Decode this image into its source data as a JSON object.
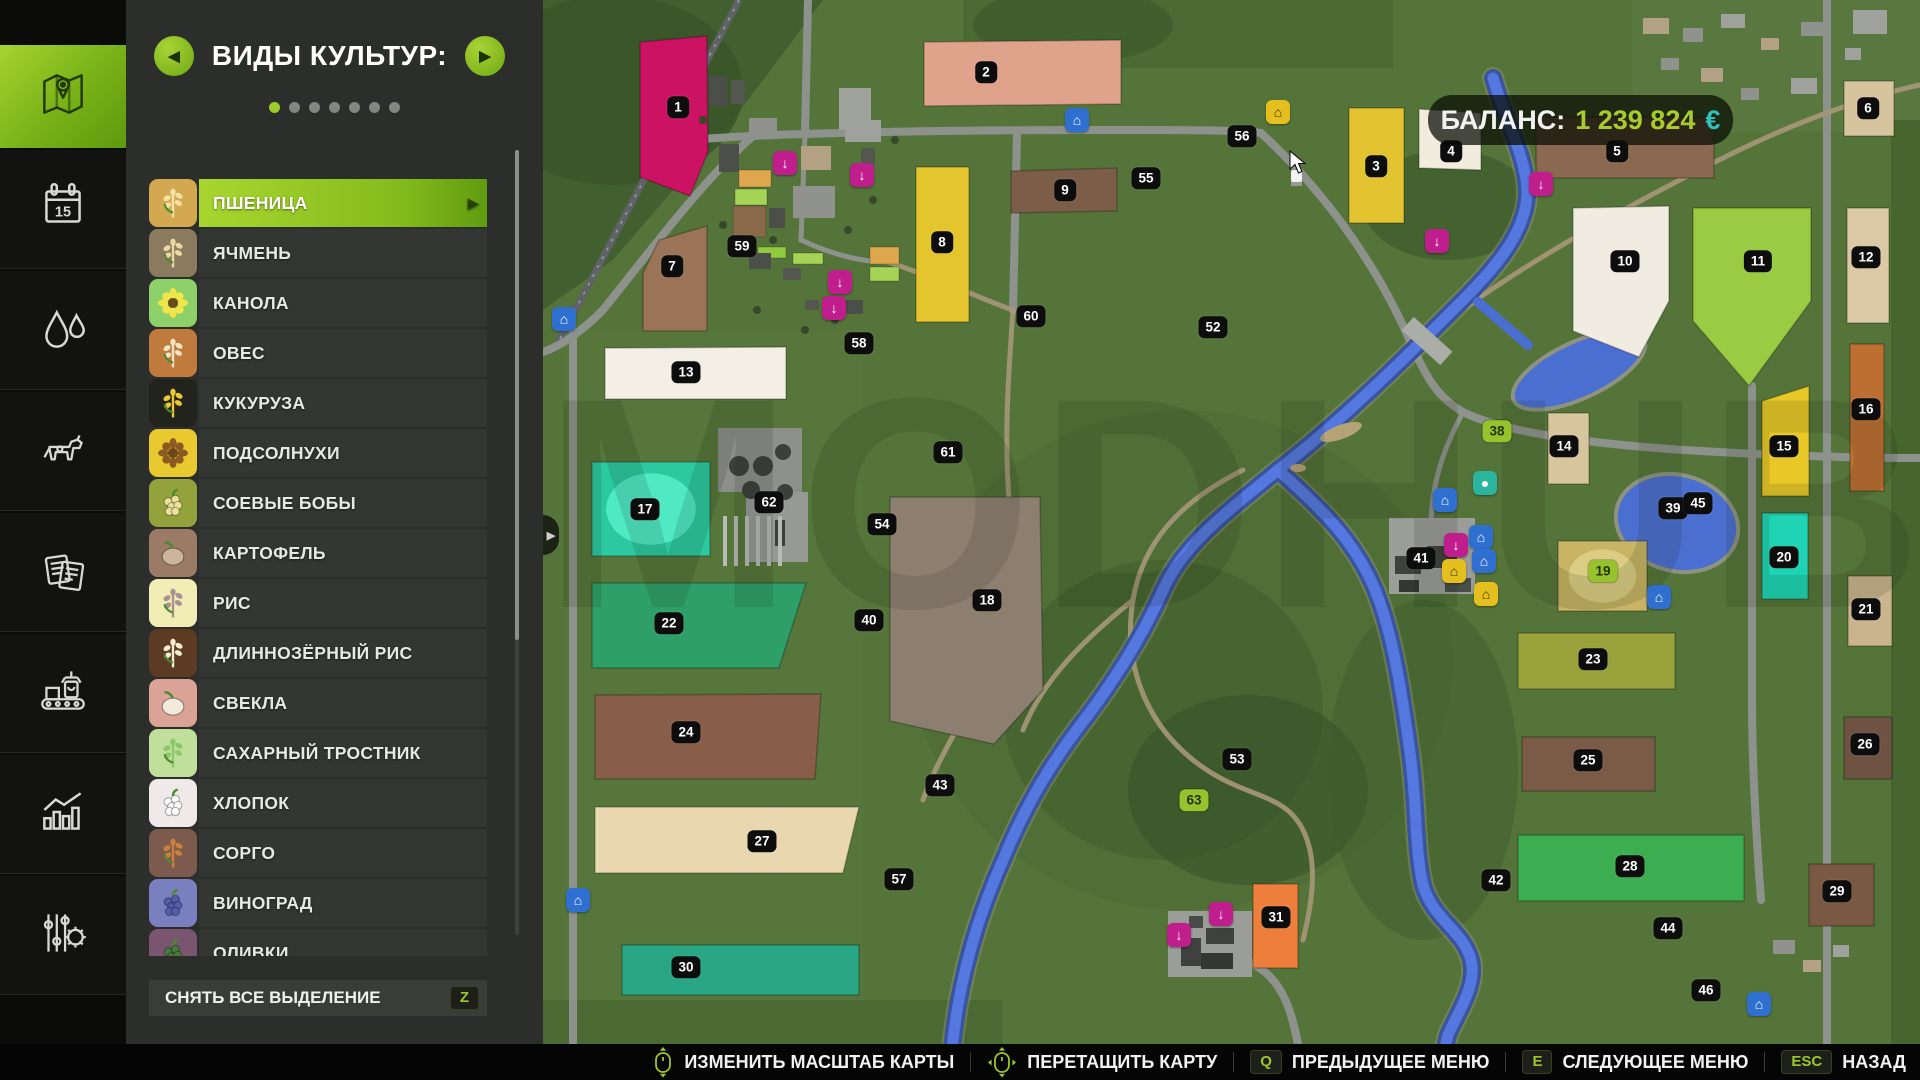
{
  "sidebar": {
    "items": [
      {
        "name": "map-tab",
        "icon": "map-icon",
        "active": true
      },
      {
        "name": "calendar-tab",
        "icon": "calendar-icon",
        "number": "15"
      },
      {
        "name": "weather-tab",
        "icon": "water-drops-icon"
      },
      {
        "name": "animals-tab",
        "icon": "cow-icon"
      },
      {
        "name": "contracts-tab",
        "icon": "documents-icon"
      },
      {
        "name": "production-tab",
        "icon": "conveyor-icon"
      },
      {
        "name": "statistics-tab",
        "icon": "bar-chart-icon"
      },
      {
        "name": "settings-tab",
        "icon": "sliders-gear-icon"
      }
    ]
  },
  "panel": {
    "title": "ВИДЫ КУЛЬТУР:",
    "dots_total": 7,
    "dots_active": 0,
    "crops": [
      {
        "label": "ПШЕНИЦА",
        "selected": true,
        "bg": "#d3a850",
        "fg": "#f5e2a8",
        "shape": "grain"
      },
      {
        "label": "ЯЧМЕНЬ",
        "selected": false,
        "bg": "#8a7a5e",
        "fg": "#ead9a0",
        "shape": "grain"
      },
      {
        "label": "КАНОЛА",
        "selected": false,
        "bg": "#8ed06a",
        "fg": "#f2e549",
        "shape": "flower"
      },
      {
        "label": "ОВЕС",
        "selected": false,
        "bg": "#c07a3e",
        "fg": "#f2e3c2",
        "shape": "grain"
      },
      {
        "label": "КУКУРУЗА",
        "selected": false,
        "bg": "#23231d",
        "fg": "#ecc832",
        "shape": "grain"
      },
      {
        "label": "ПОДСОЛНУХИ",
        "selected": false,
        "bg": "#e9c930",
        "fg": "#8a5a20",
        "shape": "flower"
      },
      {
        "label": "СОЕВЫЕ БОБЫ",
        "selected": false,
        "bg": "#93a23c",
        "fg": "#ece29b",
        "shape": "cluster"
      },
      {
        "label": "КАРТОФЕЛЬ",
        "selected": false,
        "bg": "#9b7b66",
        "fg": "#cbb69c",
        "shape": "round"
      },
      {
        "label": "РИС",
        "selected": false,
        "bg": "#f2edb5",
        "fg": "#a89292",
        "shape": "grain"
      },
      {
        "label": "ДЛИННОЗЁРНЫЙ РИС",
        "selected": false,
        "bg": "#5c3b22",
        "fg": "#f2ecd2",
        "shape": "grain"
      },
      {
        "label": "СВЕКЛА",
        "selected": false,
        "bg": "#daa396",
        "fg": "#f2eada",
        "shape": "round"
      },
      {
        "label": "САХАРНЫЙ ТРОСТНИК",
        "selected": false,
        "bg": "#bfdf9b",
        "fg": "#8cc86a",
        "shape": "grain"
      },
      {
        "label": "ХЛОПОК",
        "selected": false,
        "bg": "#efe9ea",
        "fg": "#ffffff",
        "shape": "cluster"
      },
      {
        "label": "СОРГО",
        "selected": false,
        "bg": "#7d5a4e",
        "fg": "#ca813a",
        "shape": "grain"
      },
      {
        "label": "ВИНОГРАД",
        "selected": false,
        "bg": "#7a7fc0",
        "fg": "#555cab",
        "shape": "cluster"
      },
      {
        "label": "ОЛИВКИ",
        "selected": false,
        "bg": "#7a5570",
        "fg": "#4a7a3a",
        "shape": "cluster"
      }
    ],
    "clear_button": {
      "label": "СНЯТЬ ВСЕ ВЫДЕЛЕНИЕ",
      "key": "Z"
    }
  },
  "map": {
    "balance": {
      "label": "БАЛАНС:",
      "value": "1 239 824",
      "currency": "€"
    },
    "watermark": "MODHUB",
    "fields": [
      {
        "n": "1",
        "color": "#cb1263",
        "points": "97,42 164,36 165,152 147,196 97,177"
      },
      {
        "n": "2",
        "color": "#dfa28b",
        "points": "381,42 578,40 578,104 381,106"
      },
      {
        "n": "3",
        "color": "#e3c430",
        "points": "806,108 861,108 861,223 806,223"
      },
      {
        "n": "4",
        "color": "#f2ecdf",
        "points": "876,109 938,113 938,170 876,168"
      },
      {
        "n": "5",
        "color": "#8a6950",
        "points": "993,117 1171,117 1171,178 993,178"
      },
      {
        "n": "6",
        "color": "#d5c49e",
        "points": "1301,81 1351,81 1351,136 1301,136"
      },
      {
        "n": "7",
        "color": "#9b7356",
        "points": "116,240 164,226 164,331 100,331 100,273"
      },
      {
        "n": "8",
        "color": "#e5c52e",
        "points": "373,167 426,167 426,322 373,322"
      },
      {
        "n": "9",
        "color": "#7c5e48",
        "points": "468,171 574,168 574,211 468,213"
      },
      {
        "n": "10",
        "color": "#f1ece2",
        "points": "1030,208 1126,206 1126,301 1096,357 1030,331"
      },
      {
        "n": "11",
        "color": "#99cb43",
        "points": "1150,208 1268,208 1268,301 1206,386 1150,321"
      },
      {
        "n": "12",
        "color": "#dbc8a4",
        "points": "1304,208 1346,208 1346,323 1304,323"
      },
      {
        "n": "13",
        "color": "#f4efe6",
        "points": "62,348 243,347 243,399 62,399"
      },
      {
        "n": "14",
        "color": "#d7c59d",
        "points": "1005,413 1046,413 1046,484 1005,484"
      },
      {
        "n": "15",
        "color": "#e7c827",
        "points": "1219,401 1266,386 1266,496 1219,496"
      },
      {
        "n": "16",
        "color": "#bd6f33",
        "points": "1307,344 1341,344 1341,491 1307,491"
      },
      {
        "n": "17",
        "color": "#2cc9a0",
        "inner": "#4fe9c4",
        "points": "49,462 167,462 167,556 49,556"
      },
      {
        "n": "18",
        "color": "#8c7f70",
        "points": "347,497 497,497 500,690 451,744 347,721"
      },
      {
        "n": "19",
        "color": "#c8b464",
        "inner": "#dccd84",
        "points": "1015,541 1104,541 1104,611 1015,611"
      },
      {
        "n": "20",
        "color": "#1fd4b4",
        "points": "1219,513 1265,513 1265,599 1219,599"
      },
      {
        "n": "21",
        "color": "#c9b48d",
        "points": "1305,576 1349,576 1349,646 1305,646"
      },
      {
        "n": "22",
        "color": "#2e9f69",
        "points": "49,583 263,583 236,668 49,668"
      },
      {
        "n": "23",
        "color": "#99a23b",
        "points": "975,633 1132,633 1132,689 975,689"
      },
      {
        "n": "24",
        "color": "#895e49",
        "points": "52,695 278,694 272,779 52,779"
      },
      {
        "n": "25",
        "color": "#795b48",
        "points": "979,737 1112,737 1112,791 979,791"
      },
      {
        "n": "26",
        "color": "#6e5342",
        "points": "1301,717 1349,717 1349,779 1301,779"
      },
      {
        "n": "27",
        "color": "#e9d8af",
        "points": "52,807 316,807 300,873 52,873"
      },
      {
        "n": "28",
        "color": "#3cad51",
        "points": "975,835 1201,835 1201,901 975,901"
      },
      {
        "n": "29",
        "color": "#795943",
        "points": "1266,864 1331,864 1331,926 1266,926"
      },
      {
        "n": "30",
        "color": "#29a683",
        "points": "79,945 316,945 316,995 79,995"
      },
      {
        "n": "31",
        "color": "#ee7e3b",
        "points": "710,884 755,884 755,968 710,968"
      }
    ],
    "badges": [
      {
        "n": "1",
        "x": 135,
        "y": 107
      },
      {
        "n": "2",
        "x": 443,
        "y": 72
      },
      {
        "n": "3",
        "x": 833,
        "y": 166
      },
      {
        "n": "4",
        "x": 908,
        "y": 151
      },
      {
        "n": "5",
        "x": 1074,
        "y": 151
      },
      {
        "n": "6",
        "x": 1325,
        "y": 108
      },
      {
        "n": "7",
        "x": 129,
        "y": 266
      },
      {
        "n": "8",
        "x": 399,
        "y": 242
      },
      {
        "n": "9",
        "x": 522,
        "y": 190
      },
      {
        "n": "10",
        "x": 1082,
        "y": 261
      },
      {
        "n": "11",
        "x": 1215,
        "y": 261
      },
      {
        "n": "12",
        "x": 1323,
        "y": 257
      },
      {
        "n": "13",
        "x": 143,
        "y": 372
      },
      {
        "n": "14",
        "x": 1021,
        "y": 446
      },
      {
        "n": "15",
        "x": 1241,
        "y": 446
      },
      {
        "n": "16",
        "x": 1323,
        "y": 409
      },
      {
        "n": "17",
        "x": 102,
        "y": 509
      },
      {
        "n": "18",
        "x": 444,
        "y": 600
      },
      {
        "n": "19",
        "x": 1060,
        "y": 571,
        "g": true
      },
      {
        "n": "20",
        "x": 1241,
        "y": 557
      },
      {
        "n": "21",
        "x": 1323,
        "y": 609
      },
      {
        "n": "22",
        "x": 126,
        "y": 623
      },
      {
        "n": "23",
        "x": 1050,
        "y": 659
      },
      {
        "n": "24",
        "x": 143,
        "y": 732
      },
      {
        "n": "25",
        "x": 1045,
        "y": 760
      },
      {
        "n": "26",
        "x": 1322,
        "y": 744
      },
      {
        "n": "27",
        "x": 219,
        "y": 841
      },
      {
        "n": "28",
        "x": 1087,
        "y": 866
      },
      {
        "n": "29",
        "x": 1294,
        "y": 891
      },
      {
        "n": "30",
        "x": 143,
        "y": 967
      },
      {
        "n": "31",
        "x": 733,
        "y": 917
      },
      {
        "n": "38",
        "x": 954,
        "y": 431,
        "g": true
      },
      {
        "n": "39",
        "x": 1130,
        "y": 508
      },
      {
        "n": "40",
        "x": 326,
        "y": 620
      },
      {
        "n": "41",
        "x": 878,
        "y": 558
      },
      {
        "n": "42",
        "x": 953,
        "y": 880
      },
      {
        "n": "43",
        "x": 397,
        "y": 785
      },
      {
        "n": "44",
        "x": 1125,
        "y": 928
      },
      {
        "n": "45",
        "x": 1155,
        "y": 503
      },
      {
        "n": "46",
        "x": 1163,
        "y": 990
      },
      {
        "n": "52",
        "x": 670,
        "y": 327
      },
      {
        "n": "53",
        "x": 694,
        "y": 759
      },
      {
        "n": "54",
        "x": 339,
        "y": 524
      },
      {
        "n": "55",
        "x": 603,
        "y": 178
      },
      {
        "n": "56",
        "x": 699,
        "y": 136
      },
      {
        "n": "57",
        "x": 356,
        "y": 879
      },
      {
        "n": "58",
        "x": 316,
        "y": 343
      },
      {
        "n": "59",
        "x": 199,
        "y": 246
      },
      {
        "n": "60",
        "x": 488,
        "y": 316
      },
      {
        "n": "61",
        "x": 405,
        "y": 452
      },
      {
        "n": "62",
        "x": 226,
        "y": 502
      },
      {
        "n": "63",
        "x": 651,
        "y": 800,
        "g": true
      }
    ],
    "pois": [
      {
        "name": "sell-point-icon",
        "x": 242,
        "y": 163,
        "c": "#c01e8c",
        "g": "↓"
      },
      {
        "name": "sell-point-icon",
        "x": 319,
        "y": 175,
        "c": "#c01e8c",
        "g": "↓"
      },
      {
        "name": "sell-point-icon",
        "x": 297,
        "y": 282,
        "c": "#c01e8c",
        "g": "↓"
      },
      {
        "name": "sell-point-icon",
        "x": 291,
        "y": 308,
        "c": "#c01e8c",
        "g": "↓"
      },
      {
        "name": "sell-point-icon",
        "x": 894,
        "y": 241,
        "c": "#c01e8c",
        "g": "↓"
      },
      {
        "name": "sell-point-icon",
        "x": 998,
        "y": 184,
        "c": "#c01e8c",
        "g": "↓"
      },
      {
        "name": "sell-point-icon",
        "x": 636,
        "y": 935,
        "c": "#c01e8c",
        "g": "↓"
      },
      {
        "name": "sell-point-icon",
        "x": 678,
        "y": 914,
        "c": "#c01e8c",
        "g": "↓"
      },
      {
        "name": "sell-point-icon",
        "x": 913,
        "y": 545,
        "c": "#c01e8c",
        "g": "↓"
      },
      {
        "name": "fuel-station-icon",
        "x": 21,
        "y": 319,
        "c": "#2f6fd0",
        "g": "⌂"
      },
      {
        "name": "fuel-station-icon",
        "x": 35,
        "y": 900,
        "c": "#2f6fd0",
        "g": "⌂"
      },
      {
        "name": "fuel-station-icon",
        "x": 534,
        "y": 120,
        "c": "#2f6fd0",
        "g": "⌂"
      },
      {
        "name": "workshop-icon",
        "x": 902,
        "y": 500,
        "c": "#2f6fd0",
        "g": "⌂"
      },
      {
        "name": "dealer-icon",
        "x": 938,
        "y": 537,
        "c": "#2f6fd0",
        "g": "⌂"
      },
      {
        "name": "dealer-icon",
        "x": 941,
        "y": 561,
        "c": "#2f6fd0",
        "g": "⌂"
      },
      {
        "name": "shop-icon",
        "x": 1116,
        "y": 597,
        "c": "#2f6fd0",
        "g": "⌂"
      },
      {
        "name": "shop-icon",
        "x": 1216,
        "y": 1004,
        "c": "#2f6fd0",
        "g": "⌂"
      },
      {
        "name": "farm-icon",
        "x": 735,
        "y": 112,
        "c": "#e5bf1e",
        "g": "⌂"
      },
      {
        "name": "farmhouse-icon",
        "x": 911,
        "y": 571,
        "c": "#e5bf1e",
        "g": "⌂"
      },
      {
        "name": "market-icon",
        "x": 943,
        "y": 594,
        "c": "#e5bf1e",
        "g": "⌂"
      },
      {
        "name": "animal-pen-icon",
        "x": 942,
        "y": 483,
        "c": "#2bb49e",
        "g": "●"
      }
    ]
  },
  "bottom_bar": {
    "items": [
      {
        "icon": "mouse-scroll-icon",
        "label": "ИЗМЕНИТЬ МАСШТАБ КАРТЫ"
      },
      {
        "icon": "mouse-drag-icon",
        "label": "ПЕРЕТАЩИТЬ КАРТУ"
      },
      {
        "key": "Q",
        "label": "ПРЕДЫДУЩЕЕ МЕНЮ"
      },
      {
        "key": "E",
        "label": "СЛЕДУЮЩЕЕ МЕНЮ"
      },
      {
        "key": "ESC",
        "label": "НАЗАД"
      }
    ]
  }
}
